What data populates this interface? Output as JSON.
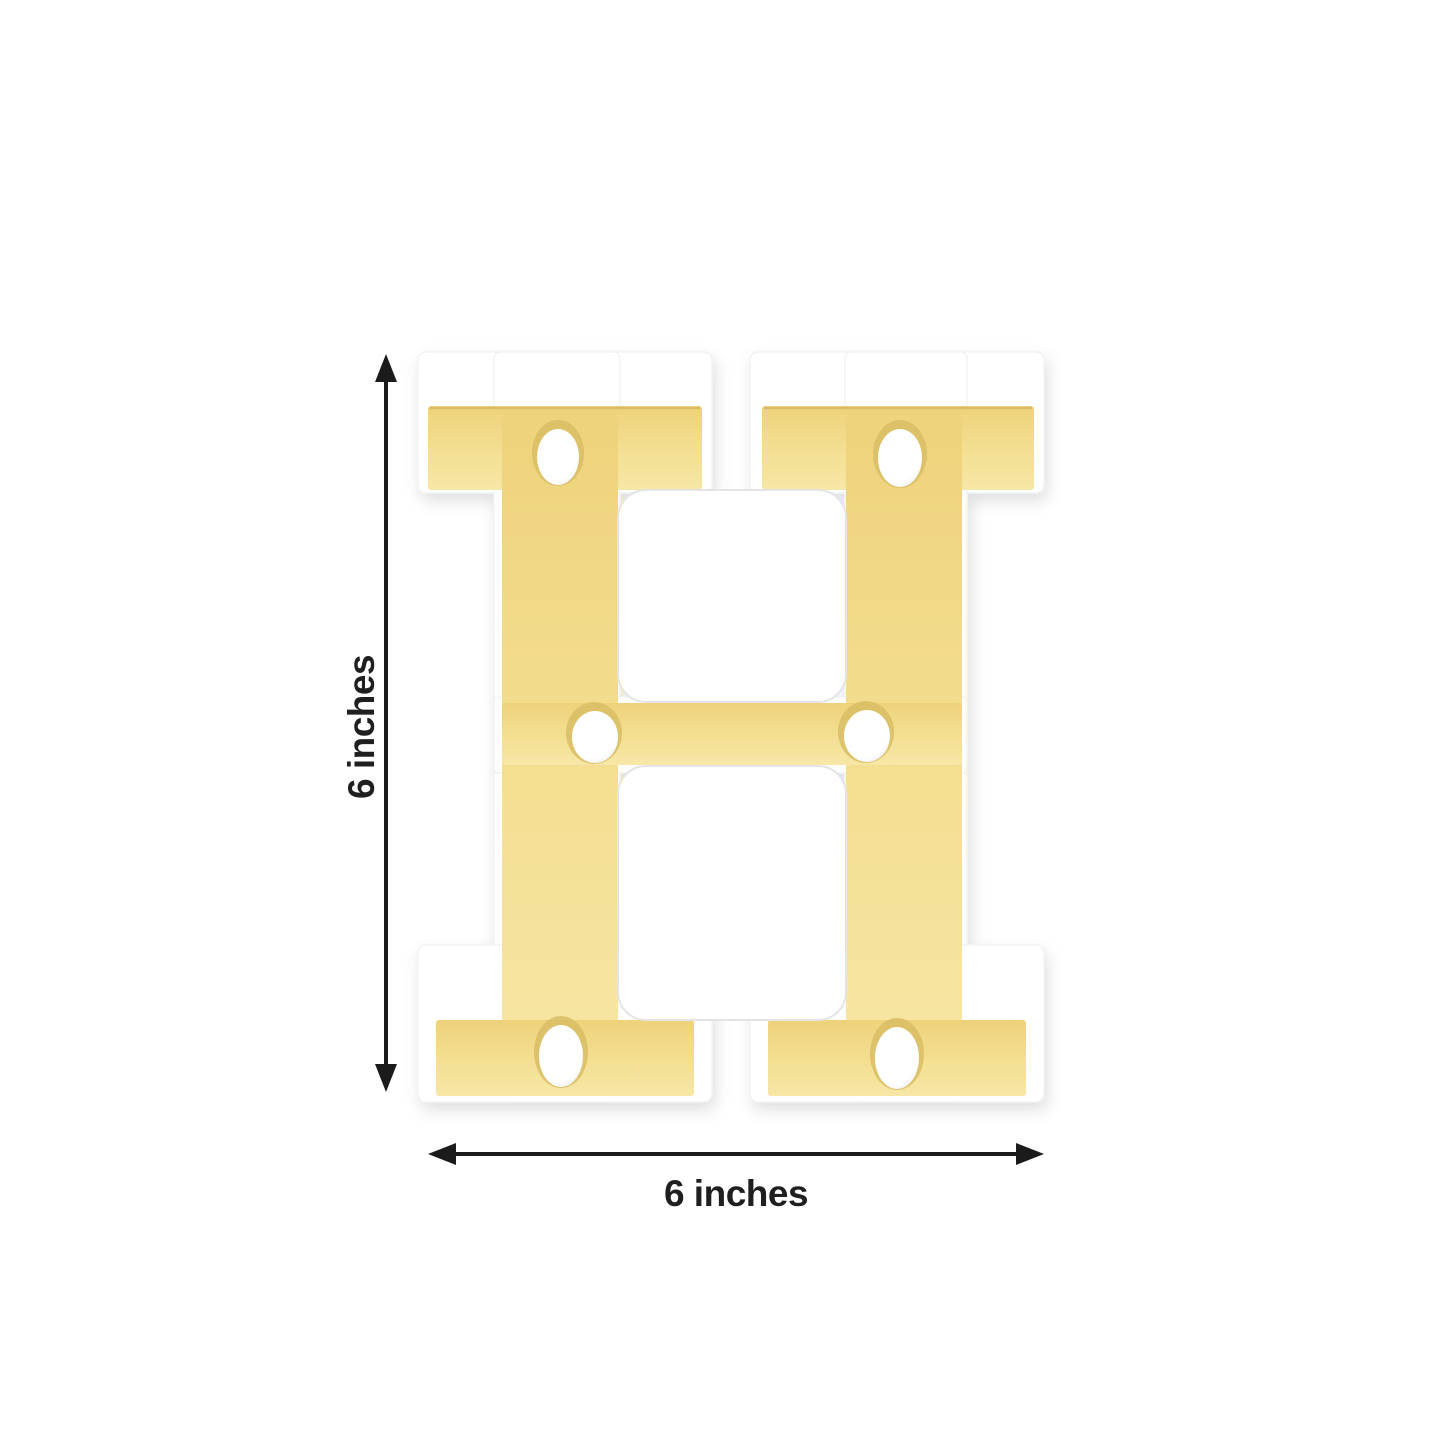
{
  "image": {
    "type": "product-photo",
    "background": "#ffffff"
  },
  "product": {
    "letter": "H",
    "description": "Gold LED marquee letter light with white frame and six LED bulbs",
    "led_count": 6,
    "colors": {
      "gold": "#eed27b",
      "gold_mid": "#f3de90",
      "gold_light": "#f7e7a6",
      "gold_edge": "#c9ac55",
      "recess": "#d8bd64",
      "body": "#ffffff",
      "seam": "#e4e4e4",
      "bulb": "#ffffff",
      "bulb_shade": "#ebebee"
    }
  },
  "dimensions": {
    "height": {
      "label": "6 inches"
    },
    "width": {
      "label": "6 inches"
    },
    "arrow_color": "#1b1b1b",
    "label_color": "#1f1f1f"
  }
}
